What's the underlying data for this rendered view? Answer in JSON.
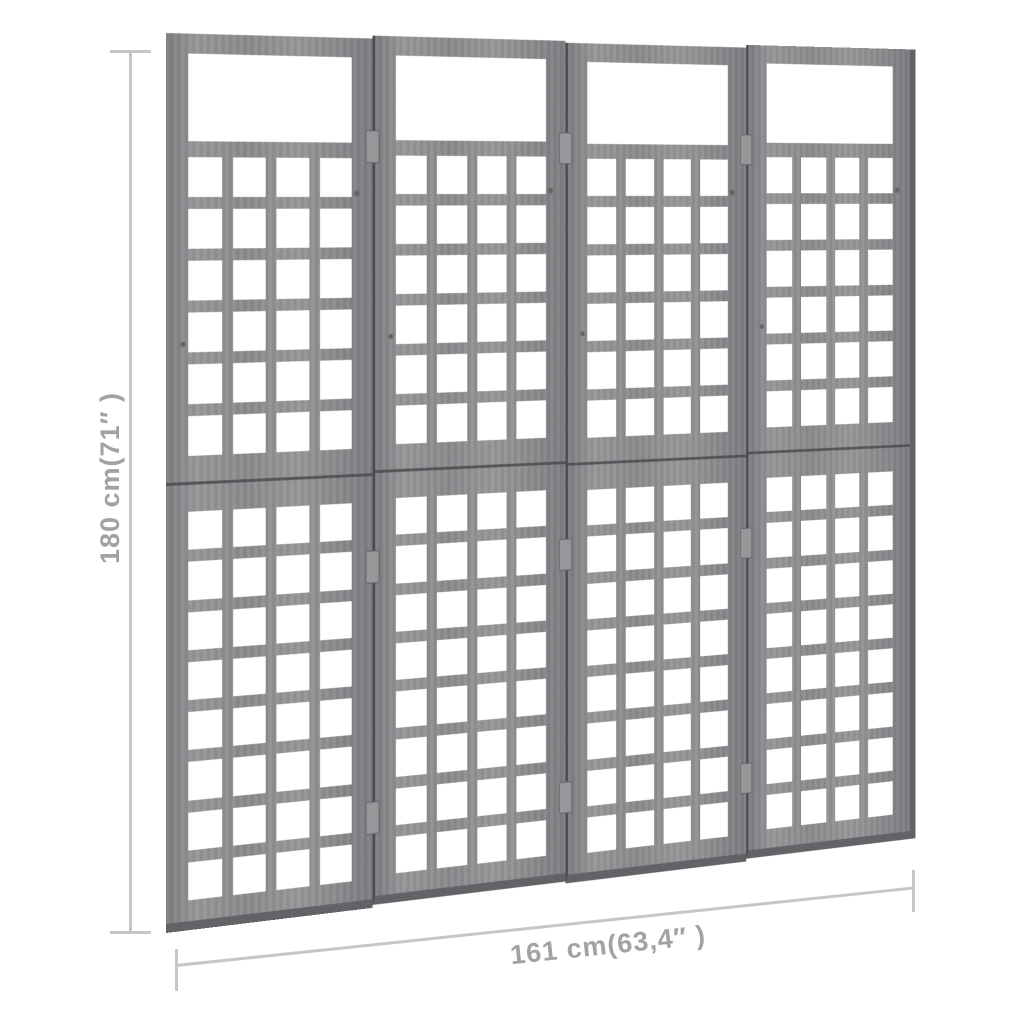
{
  "dimensions": {
    "height_label": "180 cm(71″ )",
    "width_label": "161 cm(63,4″ )"
  },
  "divider": {
    "panels": 4,
    "lattice_columns": 4,
    "upper_rows": 6,
    "lower_rows": 8,
    "has_top_window": true,
    "hinge_seams": 3,
    "hinge_positions_y": [
      95,
      530,
      790
    ]
  },
  "colors": {
    "wood_mid": "#8b8b8e",
    "wood_light": "#97979a",
    "wood_dark": "#7d7d81",
    "wood_edge": "#636367",
    "panel_seam": "#4b4b4f",
    "lattice_hole": "#ffffff",
    "background": "#ffffff",
    "dimension_line": "#c6c6c8",
    "dimension_text": "#a2a2a4"
  }
}
